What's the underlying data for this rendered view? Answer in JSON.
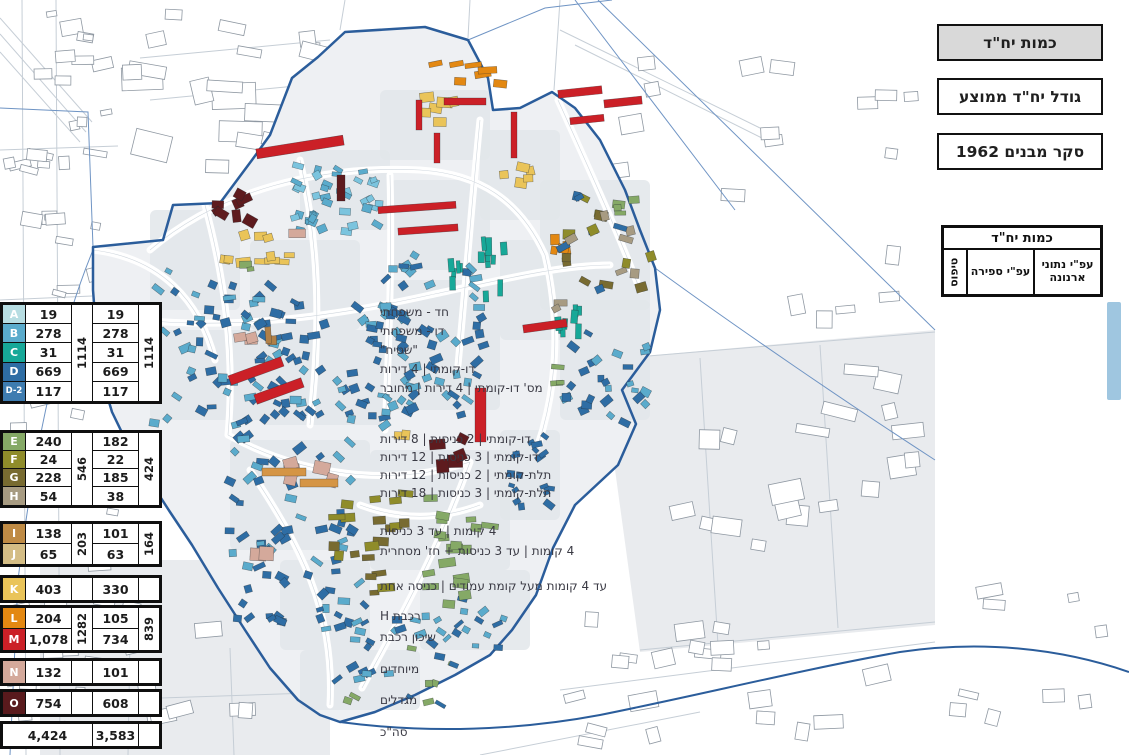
{
  "title_boxes": [
    {
      "label": "כמות יח\"ד",
      "active": true
    },
    {
      "label": "גודל יח\"ד ממוצע",
      "active": false
    },
    {
      "label": "סקר מבנים 1962",
      "active": false
    }
  ],
  "table": {
    "title": "כמות יח\"ד",
    "col_type": "טיפוס",
    "col_count": "עפ\"י ספירה",
    "col_arnona": "עפ\"י נתוני ארנונה",
    "groups": [
      {
        "rows": [
          {
            "letter": "A",
            "color": "#b7dde2",
            "label": "חד - משפחתי",
            "count": "19",
            "arnona": "19"
          },
          {
            "letter": "B",
            "color": "#5aabcc",
            "label": "דו - משפחתי",
            "count": "278",
            "arnona": "278"
          },
          {
            "letter": "C",
            "color": "#17a898",
            "label": "\"שטיח\"",
            "count": "31",
            "arnona": "31"
          },
          {
            "letter": "D",
            "color": "#2e6da4",
            "label": "דו-קומתי | 4 דירות",
            "count": "669",
            "arnona": "669"
          },
          {
            "letter": "D-2",
            "color": "#3e7cb0",
            "label": "מס' דו-קומתי | 4 דירות | מחובר",
            "count": "117",
            "arnona": "117"
          }
        ],
        "count_total": "1114",
        "arnona_total": "1114",
        "highlight_bar": true
      },
      {
        "rows": [
          {
            "letter": "E",
            "color": "#85a966",
            "label": "דו-קומתי | 2 כניסות | 8 דירות",
            "count": "240",
            "arnona": "182"
          },
          {
            "letter": "F",
            "color": "#8f8c2a",
            "label": "דו-קומתי | 3 כניסות | 12 דירות",
            "count": "24",
            "arnona": "22"
          },
          {
            "letter": "G",
            "color": "#786b31",
            "label": "תלת-קומתי | 2 כניסות | 12 דירות",
            "count": "228",
            "arnona": "185"
          },
          {
            "letter": "H",
            "color": "#a79b82",
            "label": "תלת-קומתי | 3 כניסות | 18 דירות",
            "count": "54",
            "arnona": "38"
          }
        ],
        "count_total": "546",
        "arnona_total": "424"
      },
      {
        "rows": [
          {
            "letter": "I",
            "color": "#bf8b45",
            "label": "4 קומות | עד 3 כניסות",
            "count": "138",
            "arnona": "101"
          },
          {
            "letter": "J",
            "color": "#d4bd85",
            "label": "4 קומות | עד 3 כניסות + חז' מסחרית",
            "count": "65",
            "arnona": "63"
          }
        ],
        "count_total": "203",
        "arnona_total": "164"
      },
      {
        "rows": [
          {
            "letter": "K",
            "color": "#eac459",
            "label": "עד 4 קומות מעל קומת עמודים | כניסה אחת",
            "count": "403",
            "arnona": "330"
          }
        ],
        "count_total": "",
        "arnona_total": ""
      },
      {
        "rows": [
          {
            "letter": "L",
            "color": "#e38812",
            "label": "רכבת H",
            "count": "204",
            "arnona": "105"
          },
          {
            "letter": "M",
            "color": "#cb2027",
            "label": "שיכון רכבת",
            "count": "1,078",
            "arnona": "734"
          }
        ],
        "count_total": "1282",
        "arnona_total": "839"
      },
      {
        "rows": [
          {
            "letter": "N",
            "color": "#d4a99b",
            "label": "מיוחדים",
            "count": "132",
            "arnona": "101"
          }
        ],
        "count_total": "",
        "arnona_total": ""
      },
      {
        "rows": [
          {
            "letter": "O",
            "color": "#591a1d",
            "label": "מגדלים",
            "count": "754",
            "arnona": "608"
          }
        ],
        "count_total": "",
        "arnona_total": ""
      },
      {
        "total": true,
        "rows": [
          {
            "letter": "",
            "color": "",
            "label": "סה\"כ",
            "count": "4,424",
            "arnona": "3,583"
          }
        ],
        "count_total": "",
        "arnona_total": ""
      }
    ]
  },
  "map": {
    "boundary_color": "#2b5d9b",
    "thin_blue": "#6f94c4",
    "inside_fill": "#eef0f3",
    "block_fill": "#e2e6ea",
    "gray_zone_fill": "#e9ebee",
    "outer_building_stroke": "#8f98a2",
    "road_line": "#c6ced6",
    "building_outline": "rgba(35,40,45,0.55)",
    "boundary_path": "M318,57 L345,32 L425,27 L468,40 L488,78 L493,110 L520,108 L552,92 L575,108 L600,140 L625,190 L640,230 L655,268 L660,310 L650,352 L622,390 L636,424 L618,465 L575,505 L553,548 L536,595 L512,630 L490,655 L455,675 L415,695 L375,712 L340,722 L320,715 L298,700 L270,668 L245,630 L218,588 L192,545 L170,512 L148,478 L128,445 L112,412 L101,375 L96,330 L93,290 L93,247 L163,240 L173,205 L220,203 L252,160 L270,135 L292,78 Z",
    "highway_path": "M340,722 C430,734 520,730 600,715 C700,695 800,670 900,652 C980,640 1060,648 1129,672",
    "thin_blue_paths": [
      "M0,108 L88,112 L93,247",
      "M93,250 C60,330 35,440 18,580 L10,755",
      "M575,0 L735,210",
      "M598,0 L935,330",
      "M655,268 C740,330 850,405 935,460",
      "M468,40 L545,8 L612,0"
    ],
    "gray_zones": [
      "M600,360 L935,330 L935,625 L640,652 Z",
      "M40,560 L330,560 L330,755 L40,755 Z"
    ],
    "blocks": [
      [
        150,
        210,
        90,
        100
      ],
      [
        250,
        240,
        110,
        90
      ],
      [
        300,
        150,
        90,
        80
      ],
      [
        380,
        90,
        110,
        70
      ],
      [
        390,
        180,
        100,
        90
      ],
      [
        480,
        130,
        80,
        90
      ],
      [
        540,
        180,
        110,
        130
      ],
      [
        150,
        330,
        120,
        90
      ],
      [
        260,
        330,
        130,
        95
      ],
      [
        390,
        280,
        110,
        130
      ],
      [
        500,
        240,
        70,
        100
      ],
      [
        560,
        300,
        90,
        120
      ],
      [
        230,
        440,
        140,
        110
      ],
      [
        370,
        450,
        140,
        120
      ],
      [
        420,
        570,
        110,
        80
      ],
      [
        280,
        560,
        90,
        90
      ],
      [
        300,
        650,
        120,
        60
      ],
      [
        500,
        430,
        60,
        90
      ]
    ],
    "roads": [
      "M150,250 C220,190 320,165 420,170 C480,174 520,200 545,255",
      "M140,320 C240,330 340,315 430,295 C500,280 560,265 610,265",
      "M205,205 C225,280 235,355 228,435",
      "M300,160 C318,240 322,320 310,425",
      "M390,175 C392,250 390,330 385,430",
      "M480,120 C472,200 466,280 458,365",
      "M228,435 C300,475 390,488 470,462",
      "M250,470 C300,545 335,610 330,705",
      "M470,462 C440,545 405,610 362,688",
      "M545,255 C560,320 558,385 538,445",
      "M558,100 C585,160 615,225 640,290",
      "M93,250 C160,258 200,300 215,360",
      "M360,505 C400,520 440,520 480,505"
    ],
    "outer_roads": [
      [
        22,
        0,
        26,
        755
      ],
      [
        56,
        0,
        60,
        755
      ],
      [
        0,
        150,
        118,
        146
      ],
      [
        0,
        300,
        92,
        296
      ],
      [
        0,
        452,
        110,
        448
      ],
      [
        0,
        560,
        40,
        558
      ],
      [
        140,
        58,
        330,
        40
      ],
      [
        150,
        100,
        296,
        86
      ],
      [
        345,
        0,
        340,
        30
      ],
      [
        470,
        0,
        468,
        38
      ],
      [
        560,
        0,
        554,
        90
      ],
      [
        600,
        360,
        935,
        332
      ],
      [
        640,
        650,
        935,
        622
      ],
      [
        700,
        358,
        718,
        645
      ],
      [
        820,
        345,
        838,
        628
      ],
      [
        100,
        700,
        340,
        692
      ],
      [
        480,
        755,
        700,
        712
      ],
      [
        560,
        690,
        935,
        642
      ],
      [
        130,
        640,
        128,
        755
      ],
      [
        230,
        648,
        234,
        755
      ],
      [
        0,
        18,
        92,
        122
      ],
      [
        0,
        34,
        86,
        132
      ],
      [
        0,
        52,
        80,
        142
      ],
      [
        560,
        30,
        760,
        128
      ],
      [
        575,
        45,
        770,
        142
      ]
    ],
    "outer_building_zones": [
      [
        4,
        4,
        112,
        250,
        26,
        8,
        26
      ],
      [
        4,
        262,
        112,
        228,
        20,
        8,
        26
      ],
      [
        4,
        498,
        120,
        250,
        20,
        8,
        26
      ],
      [
        105,
        55,
        190,
        148,
        12,
        18,
        44
      ],
      [
        140,
        8,
        190,
        55,
        7,
        10,
        28
      ],
      [
        590,
        55,
        210,
        150,
        9,
        12,
        30
      ],
      [
        665,
        245,
        260,
        330,
        24,
        12,
        36
      ],
      [
        560,
        612,
        370,
        135,
        22,
        10,
        30
      ],
      [
        60,
        602,
        250,
        148,
        15,
        10,
        28
      ],
      [
        940,
        565,
        180,
        185,
        9,
        10,
        26
      ],
      [
        300,
        68,
        160,
        92,
        9,
        14,
        34
      ],
      [
        480,
        120,
        70,
        58,
        5,
        10,
        22
      ],
      [
        820,
        60,
        100,
        120,
        4,
        10,
        24
      ]
    ],
    "clusters": [
      [
        192,
        186,
        66,
        58,
        8,
        [
          "#5e1b1e"
        ],
        11,
        9,
        35
      ],
      [
        238,
        224,
        36,
        22,
        3,
        [
          "#eac459"
        ],
        11,
        9,
        20
      ],
      [
        188,
        250,
        120,
        18,
        8,
        [
          "#eac459"
        ],
        11,
        7,
        10
      ],
      [
        230,
        258,
        24,
        14,
        2,
        [
          "#85a966"
        ],
        9,
        6,
        10
      ],
      [
        415,
        86,
        44,
        46,
        6,
        [
          "#eac459"
        ],
        12,
        8,
        15
      ],
      [
        498,
        162,
        38,
        40,
        5,
        [
          "#eac459"
        ],
        11,
        8,
        15
      ],
      [
        425,
        60,
        92,
        38,
        7,
        [
          "#e38812"
        ],
        14,
        7,
        12
      ],
      [
        543,
        225,
        30,
        58,
        4,
        [
          "#e38812"
        ],
        9,
        10,
        10
      ],
      [
        552,
        182,
        105,
        135,
        26,
        [
          "#8f8c2a",
          "#786b31",
          "#a79b82",
          "#2e6da4"
        ],
        10,
        7,
        30
      ],
      [
        142,
        268,
        150,
        160,
        60,
        [
          "#2e6da4",
          "#2e6da4",
          "#5aabcc"
        ],
        9,
        6,
        45
      ],
      [
        250,
        300,
        170,
        130,
        70,
        [
          "#2e6da4",
          "#5aabcc",
          "#2e6da4"
        ],
        9,
        6,
        45
      ],
      [
        288,
        160,
        95,
        78,
        40,
        [
          "#5aabcc",
          "#7bc4de"
        ],
        8,
        6,
        35
      ],
      [
        380,
        250,
        110,
        170,
        55,
        [
          "#2e6da4",
          "#5aabcc"
        ],
        9,
        6,
        45
      ],
      [
        478,
        226,
        30,
        78,
        9,
        [
          "#17a898"
        ],
        5,
        13,
        6
      ],
      [
        552,
        296,
        32,
        58,
        8,
        [
          "#17a898"
        ],
        5,
        12,
        6
      ],
      [
        448,
        255,
        22,
        46,
        5,
        [
          "#17a898"
        ],
        5,
        11,
        6
      ],
      [
        560,
        330,
        98,
        98,
        26,
        [
          "#2e6da4",
          "#5aabcc"
        ],
        8,
        6,
        45
      ],
      [
        225,
        432,
        145,
        200,
        70,
        [
          "#2e6da4",
          "#2e6da4",
          "#5aabcc"
        ],
        9,
        6,
        45
      ],
      [
        498,
        430,
        60,
        95,
        18,
        [
          "#2e6da4"
        ],
        8,
        5,
        45
      ],
      [
        350,
        596,
        160,
        55,
        28,
        [
          "#2e6da4",
          "#5aabcc"
        ],
        8,
        5,
        45
      ],
      [
        362,
        468,
        55,
        152,
        14,
        [
          "#786b31",
          "#8f8c2a"
        ],
        13,
        7,
        8
      ],
      [
        320,
        497,
        42,
        68,
        6,
        [
          "#8f8c2a",
          "#786b31"
        ],
        12,
        7,
        8
      ],
      [
        420,
        482,
        85,
        142,
        18,
        [
          "#85a966"
        ],
        13,
        7,
        10
      ],
      [
        424,
        434,
        46,
        44,
        5,
        [
          "#5e1b1e"
        ],
        12,
        10,
        35
      ],
      [
        282,
        453,
        64,
        40,
        5,
        [
          "#d4a99b"
        ],
        12,
        10,
        25
      ],
      [
        228,
        330,
        32,
        20,
        3,
        [
          "#d4a99b"
        ],
        10,
        8,
        20
      ],
      [
        250,
        544,
        24,
        22,
        2,
        [
          "#d4a99b"
        ],
        13,
        11,
        5
      ],
      [
        545,
        362,
        30,
        24,
        3,
        [
          "#85a966"
        ],
        10,
        6,
        10
      ],
      [
        608,
        188,
        34,
        28,
        4,
        [
          "#85a966"
        ],
        10,
        6,
        10
      ],
      [
        330,
        645,
        130,
        65,
        18,
        [
          "#2e6da4",
          "#5aabcc",
          "#85a966"
        ],
        8,
        5,
        40
      ],
      [
        288,
        228,
        14,
        14,
        1,
        [
          "#d4a99b"
        ],
        12,
        12,
        0
      ],
      [
        262,
        322,
        16,
        26,
        2,
        [
          "#b08048"
        ],
        7,
        12,
        5
      ],
      [
        394,
        428,
        18,
        12,
        2,
        [
          "#eac459"
        ],
        9,
        7,
        10
      ]
    ],
    "red_bars": [
      [
        416,
        100,
        6,
        30,
        0
      ],
      [
        434,
        133,
        6,
        30,
        0
      ],
      [
        444,
        98,
        42,
        7,
        0
      ],
      [
        511,
        112,
        6,
        46,
        0
      ],
      [
        378,
        204,
        78,
        7,
        -4
      ],
      [
        398,
        226,
        60,
        7,
        -4
      ],
      [
        558,
        88,
        44,
        8,
        -6
      ],
      [
        604,
        98,
        38,
        8,
        -6
      ],
      [
        570,
        116,
        34,
        7,
        -6
      ],
      [
        256,
        142,
        88,
        10,
        -9
      ],
      [
        228,
        366,
        56,
        10,
        -20
      ],
      [
        254,
        386,
        50,
        10,
        -20
      ],
      [
        475,
        388,
        11,
        54,
        0
      ],
      [
        523,
        322,
        44,
        8,
        -8
      ]
    ],
    "maroon_bars": [
      [
        337,
        175,
        8,
        26,
        0
      ]
    ],
    "orange_bars": [
      [
        262,
        468,
        44,
        8,
        0
      ],
      [
        300,
        479,
        38,
        8,
        0
      ]
    ],
    "red_color": "#cb2027",
    "maroon_color": "#5e1b1e",
    "orange_bar_color": "#d59545"
  }
}
